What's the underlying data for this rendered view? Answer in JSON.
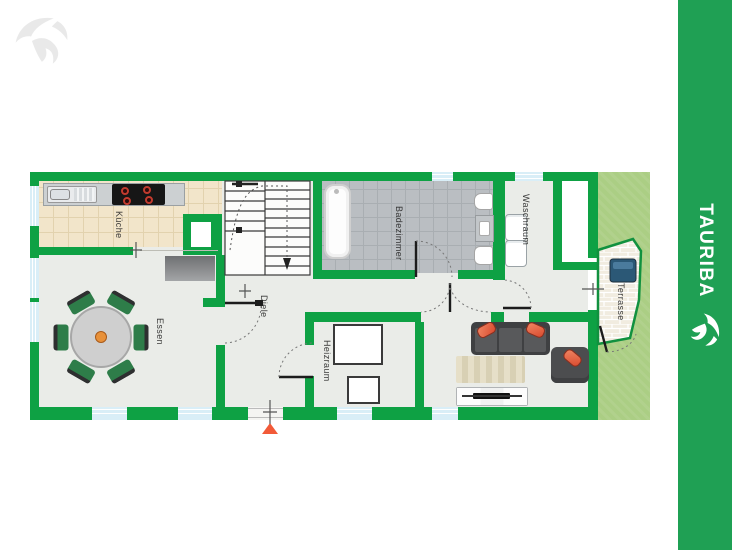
{
  "brand": {
    "name": "TAURIBA",
    "icon": "bull-logo-icon"
  },
  "watermark": {
    "icon": "bull-logo-icon"
  },
  "rooms": {
    "kueche": "Küche",
    "essen": "Essen",
    "diele": "Diele",
    "heizraum": "Heizraum",
    "badezimmer": "Badezimmer",
    "waschraum": "Waschraum",
    "terrasse": "Terrasse"
  },
  "markers": {
    "entrance": "entrance-arrow-icon"
  },
  "colors": {
    "wall_green": "#0EA144",
    "sidebar_green": "#1FA054",
    "floor": "#EAECE8",
    "kitchen_tile": "#F2E5CA",
    "bath_tile": "#BABEC2",
    "window_blue": "#D9EEF7",
    "grass": "#ABCE84",
    "paving": "#F1ECE0",
    "entrance_orange": "#F25A38"
  }
}
